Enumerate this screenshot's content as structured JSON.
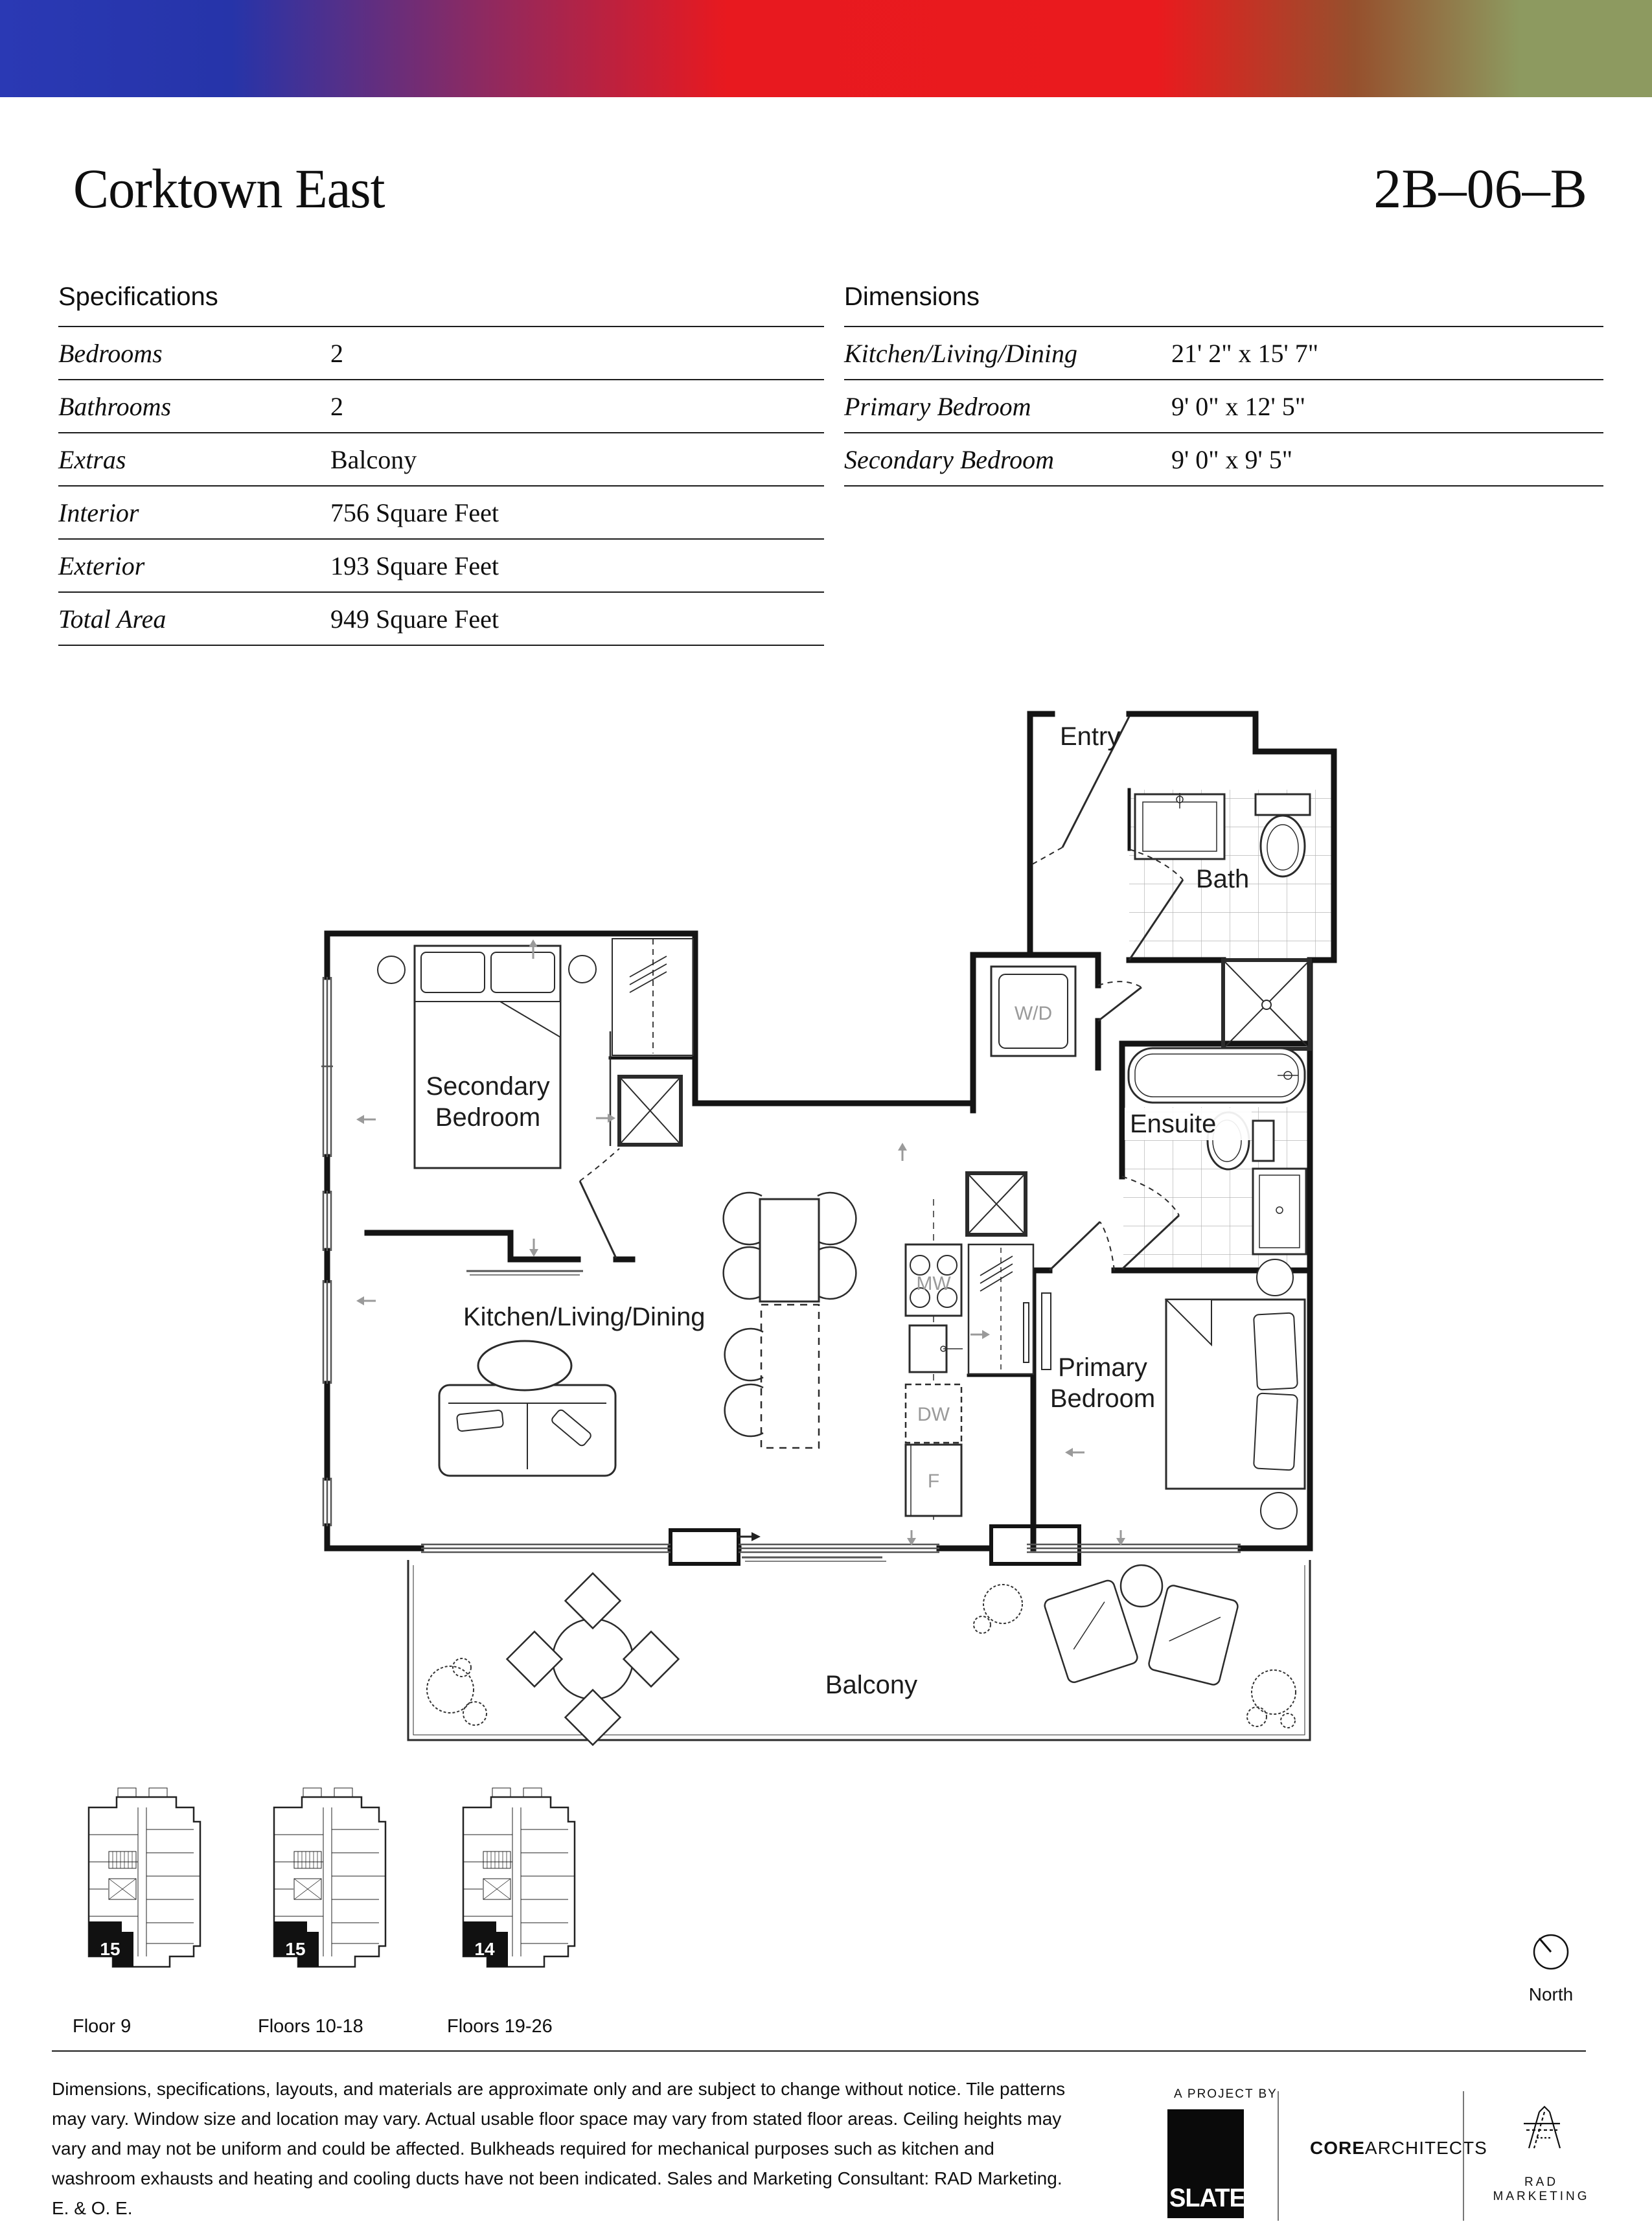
{
  "banner": {
    "colors": [
      "#2a39b4",
      "#e8191f",
      "#8d9a60"
    ]
  },
  "header": {
    "title": "Corktown East",
    "unit": "2B–06–B"
  },
  "specs": {
    "heading": "Specifications",
    "rows": [
      {
        "label": "Bedrooms",
        "value": "2"
      },
      {
        "label": "Bathrooms",
        "value": "2"
      },
      {
        "label": "Extras",
        "value": "Balcony"
      },
      {
        "label": "Interior",
        "value": "756 Square Feet"
      },
      {
        "label": "Exterior",
        "value": "193 Square Feet"
      },
      {
        "label": "Total Area",
        "value": "949 Square Feet"
      }
    ]
  },
  "dimensions": {
    "heading": "Dimensions",
    "rows": [
      {
        "label": "Kitchen/Living/Dining",
        "value": "21' 2\" x 15' 7\""
      },
      {
        "label": "Primary Bedroom",
        "value": "9' 0\" x 12' 5\""
      },
      {
        "label": "Secondary Bedroom",
        "value": "9' 0\" x 9' 5\""
      }
    ]
  },
  "floorplan": {
    "labels": {
      "entry": "Entry",
      "bath": "Bath",
      "wd": "W/D",
      "ensuite": "Ensuite",
      "secondary_line1": "Secondary",
      "secondary_line2": "Bedroom",
      "kld": "Kitchen/Living/Dining",
      "mw": "MW",
      "dw": "DW",
      "fridge": "F",
      "primary_line1": "Primary",
      "primary_line2": "Bedroom",
      "balcony": "Balcony"
    }
  },
  "keyplans": {
    "items": [
      {
        "number": "15",
        "caption": "Floor 9"
      },
      {
        "number": "15",
        "caption": "Floors 10-18"
      },
      {
        "number": "14",
        "caption": "Floors 19-26"
      }
    ],
    "north_label": "North"
  },
  "footer": {
    "disclaimer": "Dimensions, specifications, layouts, and materials are approximate only and are subject to change without notice. Tile patterns may vary. Window size and location may vary. Actual usable floor space may vary from stated floor areas. Ceiling heights may vary and may not be uniform and could be affected. Bulkheads required for mechanical purposes such as kitchen and washroom exhausts and heating and cooling ducts have not been indicated. Sales and Marketing Consultant: RAD Marketing. E. & O. E.",
    "project_kicker": "A PROJECT BY",
    "slate": "SLATE",
    "architect_bold": "CORE",
    "architect_rest": "ARCHITECTS",
    "marketing": "RAD MARKETING"
  }
}
